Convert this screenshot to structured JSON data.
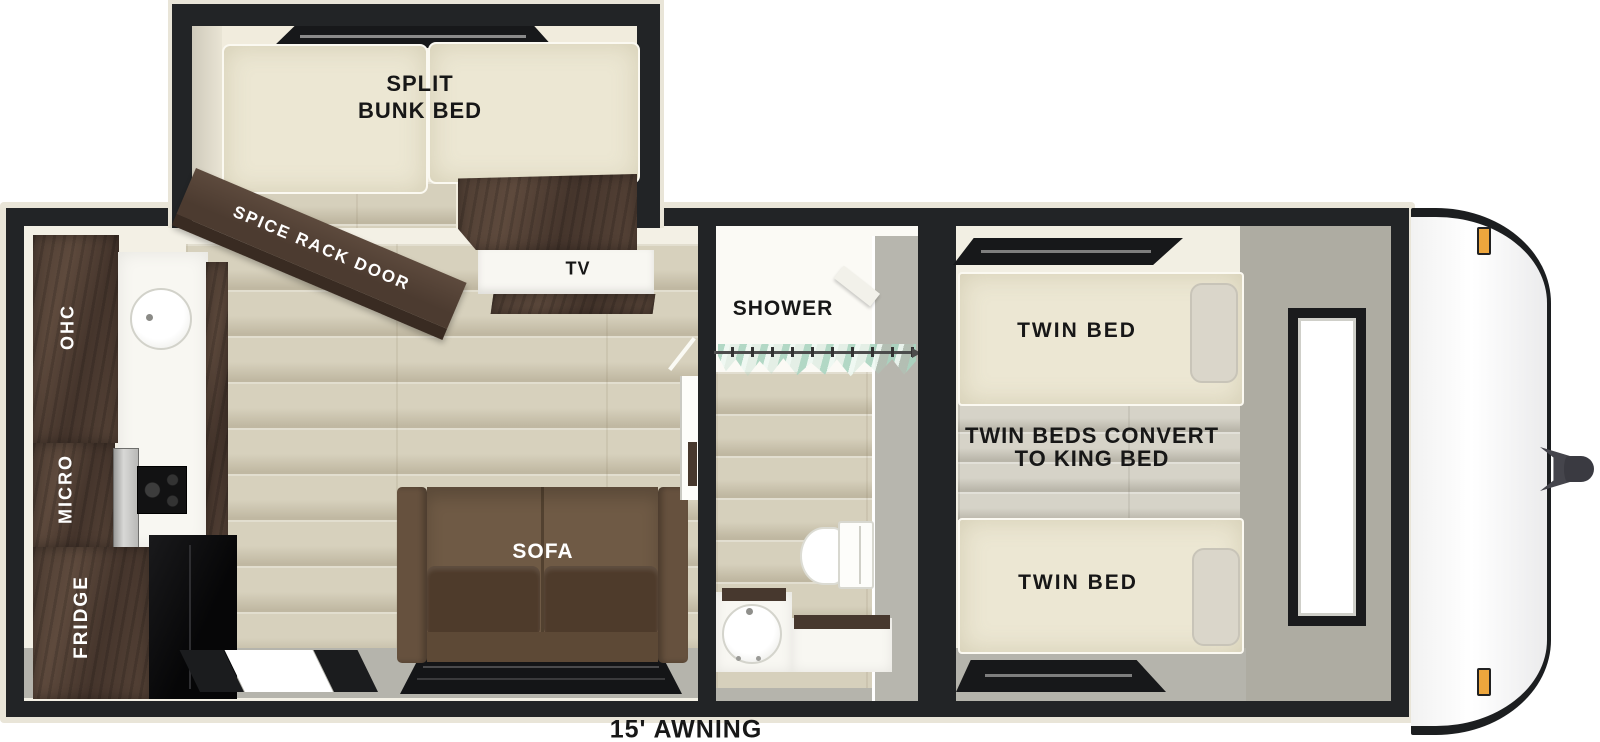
{
  "labels": {
    "bunk_line1": "SPLIT",
    "bunk_line2": "BUNK BED",
    "spice_rack": "SPICE RACK DOOR",
    "tv": "TV",
    "ohc": "OHC",
    "micro": "MICRO",
    "fridge": "FRIDGE",
    "sofa": "SOFA",
    "shower": "SHOWER",
    "twin_bed_top": "TWIN BED",
    "convert_line1": "TWIN BEDS CONVERT",
    "convert_line2": "TO KING BED",
    "twin_bed_bottom": "TWIN BED",
    "awning": "15' AWNING"
  },
  "colors": {
    "wall": "#222426",
    "outer_trim": "#e9e5d8",
    "interior": "#f3f0e5",
    "wood_floor": "#d6d0bc",
    "gray_floor": "#b5b4ac",
    "dark_cabinet": "#503f34",
    "mattress": "#ece7d3",
    "sofa_back": "#6f5a45",
    "sofa_cushion": "#4e3b2b",
    "curtain": "#bfe0d2",
    "marker_light": "#eda63d",
    "appliance_black": "#101011"
  }
}
